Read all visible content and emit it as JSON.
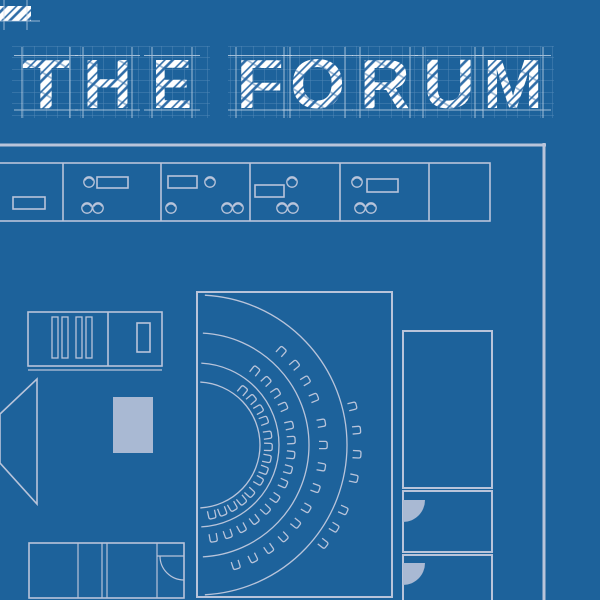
{
  "title": {
    "text": "THE FORUM",
    "baseline": 108,
    "font_size": 70,
    "letters": [
      {
        "ch": "T",
        "x": 22,
        "w": 48
      },
      {
        "ch": "H",
        "x": 83,
        "w": 49
      },
      {
        "ch": "E",
        "x": 152,
        "w": 40
      },
      {
        "ch": "F",
        "x": 236,
        "w": 48
      },
      {
        "ch": "O",
        "x": 290,
        "w": 55
      },
      {
        "ch": "R",
        "x": 360,
        "w": 50
      },
      {
        "ch": "U",
        "x": 423,
        "w": 52
      },
      {
        "ch": "M",
        "x": 483,
        "w": 60
      }
    ],
    "grid_boxes": [
      {
        "x": 12,
        "y": 46,
        "w": 198,
        "h": 72
      },
      {
        "x": 228,
        "y": 46,
        "w": 326,
        "h": 72
      }
    ]
  },
  "fragment": {
    "x": 0,
    "y": 6,
    "w": 31,
    "h": 15
  },
  "colors": {
    "background": "#1d629b",
    "line": "#b9c4da",
    "solid_fill": "#a9b9d3",
    "letter_white": "#ffffff",
    "hatch_blue": "#2e6ca7",
    "fine_grid": "#8fb3d6",
    "guide": "#cddcec"
  },
  "plan": {
    "walls": {
      "top": {
        "x1": 0,
        "x2": 546,
        "y": 145,
        "w": 3
      },
      "right": {
        "x": 544,
        "y1": 143,
        "y2": 600,
        "w": 3
      }
    },
    "office_band": {
      "x1": -3,
      "x2": 490,
      "y1": 163,
      "y2": 221,
      "dividers": [
        63,
        161,
        250,
        340,
        429
      ]
    },
    "desks": [
      {
        "x": 13,
        "y": 197,
        "w": 32,
        "h": 12
      },
      {
        "x": 97,
        "y": 177,
        "w": 31,
        "h": 11
      },
      {
        "x": 168,
        "y": 176,
        "w": 29,
        "h": 12
      },
      {
        "x": 255,
        "y": 185,
        "w": 29,
        "h": 12
      },
      {
        "x": 367,
        "y": 179,
        "w": 31,
        "h": 13
      }
    ],
    "office_chairs": [
      {
        "x": 89,
        "y": 182
      },
      {
        "x": 87,
        "y": 208
      },
      {
        "x": 98,
        "y": 208
      },
      {
        "x": 210,
        "y": 182
      },
      {
        "x": 171,
        "y": 208
      },
      {
        "x": 227,
        "y": 208
      },
      {
        "x": 238,
        "y": 208
      },
      {
        "x": 292,
        "y": 182
      },
      {
        "x": 282,
        "y": 208
      },
      {
        "x": 293,
        "y": 208
      },
      {
        "x": 357,
        "y": 182
      },
      {
        "x": 360,
        "y": 208
      },
      {
        "x": 371,
        "y": 208
      }
    ],
    "forum_room": {
      "x": 197,
      "y": 292,
      "w": 195,
      "h": 305
    },
    "forum_center": {
      "cx": 197,
      "cy": 445
    },
    "row_arcs": [
      63,
      82,
      112,
      150
    ],
    "arc_span": [
      -87,
      87
    ],
    "seat_rows": [
      {
        "r": 71,
        "clusters": [
          [
            -50,
            -20,
            4
          ],
          [
            -8,
            30,
            5
          ],
          [
            42,
            78,
            5
          ]
        ]
      },
      {
        "r": 94,
        "clusters": [
          [
            -52,
            -24,
            4
          ],
          [
            -12,
            24,
            5
          ],
          [
            34,
            80,
            6
          ]
        ]
      },
      {
        "r": 126,
        "clusters": [
          [
            -48,
            -22,
            4
          ],
          [
            -10,
            20,
            4
          ],
          [
            30,
            72,
            6
          ]
        ]
      },
      {
        "r": 160,
        "clusters": [
          [
            -14,
            12,
            4
          ],
          [
            24,
            38,
            3
          ]
        ]
      }
    ],
    "right_rooms": [
      {
        "x": 403,
        "y": 331,
        "w": 89,
        "h": 157
      },
      {
        "x": 403,
        "y": 491,
        "w": 89,
        "h": 61
      },
      {
        "x": 403,
        "y": 555,
        "w": 89,
        "h": 47
      }
    ],
    "door_fans": [
      {
        "x": 403,
        "y": 500,
        "r": 22
      },
      {
        "x": 403,
        "y": 563,
        "r": 22
      }
    ],
    "shelf_unit": {
      "x": 28,
      "y": 312,
      "w": 134,
      "h": 54,
      "divider_x": 108,
      "slats": [
        52,
        62,
        76,
        86
      ],
      "slat_y": 317,
      "slat_w": 6,
      "slat_h": 41,
      "inner_rect": {
        "x": 137,
        "y": 323,
        "w": 13,
        "h": 29
      },
      "under_line_y": 370
    },
    "table": {
      "x": 113,
      "y": 397,
      "w": 40,
      "h": 56
    },
    "stage_pointer": [
      [
        0,
        414
      ],
      [
        37,
        379
      ],
      [
        37,
        504
      ],
      [
        0,
        463
      ]
    ],
    "bottom_cabinet": {
      "x": 29,
      "y": 543,
      "w": 155,
      "h": 55,
      "dividers": [
        78,
        102,
        107,
        157
      ],
      "door": {
        "leaf": [
          157,
          556,
          184,
          556
        ],
        "arc": {
          "from": [
            160,
            556
          ],
          "to": [
            184,
            580
          ],
          "r": 24
        }
      }
    }
  }
}
